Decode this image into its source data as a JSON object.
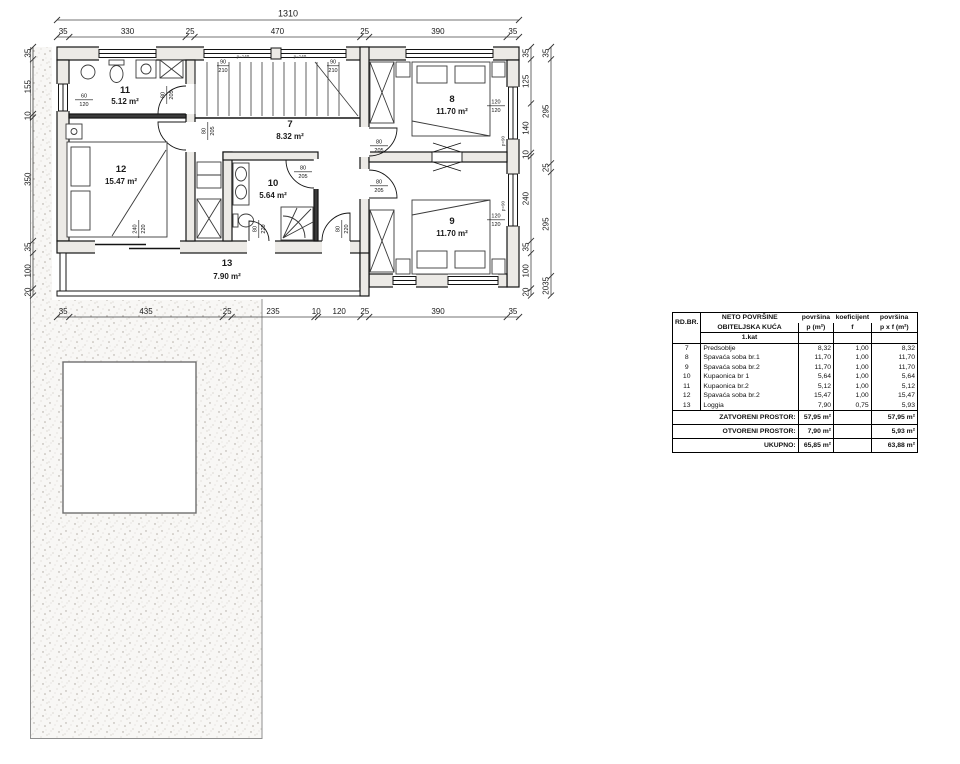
{
  "plan": {
    "dim_top_total": "1310",
    "dim_top": [
      "35",
      "330",
      "25",
      "470",
      "25",
      "390",
      "35"
    ],
    "dim_bottom": [
      "35",
      "435",
      "25",
      "235",
      "10",
      "120",
      "25",
      "390",
      "35"
    ],
    "dim_left": [
      "35",
      "155",
      "10",
      "350",
      "35",
      "100",
      "20"
    ],
    "dim_right_inner": [
      "35",
      "125",
      "140",
      "10",
      "240",
      "35",
      "100",
      "20"
    ],
    "dim_right_outer": [
      "35",
      "295",
      "25",
      "295",
      "2035"
    ],
    "rooms": {
      "r7": {
        "no": "7",
        "area": "8.32 m²"
      },
      "r8": {
        "no": "8",
        "area": "11.70 m²"
      },
      "r9": {
        "no": "9",
        "area": "11.70 m²"
      },
      "r10": {
        "no": "10",
        "area": "5.64 m²"
      },
      "r11": {
        "no": "11",
        "area": "5.12 m²"
      },
      "r12": {
        "no": "12",
        "area": "15.47 m²"
      },
      "r13": {
        "no": "13",
        "area": "7.90 m²"
      }
    },
    "openings": {
      "w11": {
        "t": "60",
        "b": "120"
      },
      "d11": {
        "t": "80",
        "b": "205"
      },
      "d12": {
        "t": "80",
        "b": "205"
      },
      "d10": {
        "t": "80",
        "b": "205"
      },
      "d8": {
        "t": "80",
        "b": "205"
      },
      "d9": {
        "t": "80",
        "b": "205"
      },
      "dl1": {
        "t": "80",
        "b": "220"
      },
      "dl2": {
        "t": "80",
        "b": "220"
      },
      "dsl": {
        "t": "240",
        "b": "220"
      },
      "w8": {
        "t": "120",
        "b": "120"
      },
      "w9": {
        "t": "120",
        "b": "120"
      },
      "ws1": {
        "t": "90",
        "b": "210"
      },
      "ws2": {
        "t": "90",
        "b": "210"
      },
      "p140a": "p=140",
      "p140b": "p=140",
      "p90a": "p=90",
      "p90b": "p=90"
    }
  },
  "table": {
    "header": {
      "rdbr": "RD.BR.",
      "neto": "NETO POVRŠINE",
      "col_p_title": "površina",
      "col_f_title": "koeficijent",
      "col_pf_title": "površina",
      "house": "OBITELJSKA KUĆA",
      "col_p": "p (m²)",
      "col_f": "f",
      "col_pf": "p x f (m²)"
    },
    "section": "1.kat",
    "rows": [
      {
        "no": "7",
        "name": "Predsoblje",
        "p": "8,32",
        "f": "1,00",
        "pf": "8,32"
      },
      {
        "no": "8",
        "name": "Spavaća soba br.1",
        "p": "11,70",
        "f": "1,00",
        "pf": "11,70"
      },
      {
        "no": "9",
        "name": "Spavaća soba br.2",
        "p": "11,70",
        "f": "1,00",
        "pf": "11,70"
      },
      {
        "no": "10",
        "name": "Kupaonica br 1",
        "p": "5,64",
        "f": "1,00",
        "pf": "5,64"
      },
      {
        "no": "11",
        "name": "Kupaonica br.2",
        "p": "5,12",
        "f": "1,00",
        "pf": "5,12"
      },
      {
        "no": "12",
        "name": "Spavaća soba br.2",
        "p": "15,47",
        "f": "1,00",
        "pf": "15,47"
      },
      {
        "no": "13",
        "name": "Loggia",
        "p": "7,90",
        "f": "0,75",
        "pf": "5,93"
      }
    ],
    "totals": [
      {
        "label": "ZATVORENI PROSTOR:",
        "p": "57,95 m²",
        "pf": "57,95 m²"
      },
      {
        "label": "OTVORENI PROSTOR:",
        "p": "7,90 m²",
        "pf": "5,93 m²"
      },
      {
        "label": "UKUPNO:",
        "p": "65,85 m²",
        "pf": "63,88 m²"
      }
    ]
  }
}
